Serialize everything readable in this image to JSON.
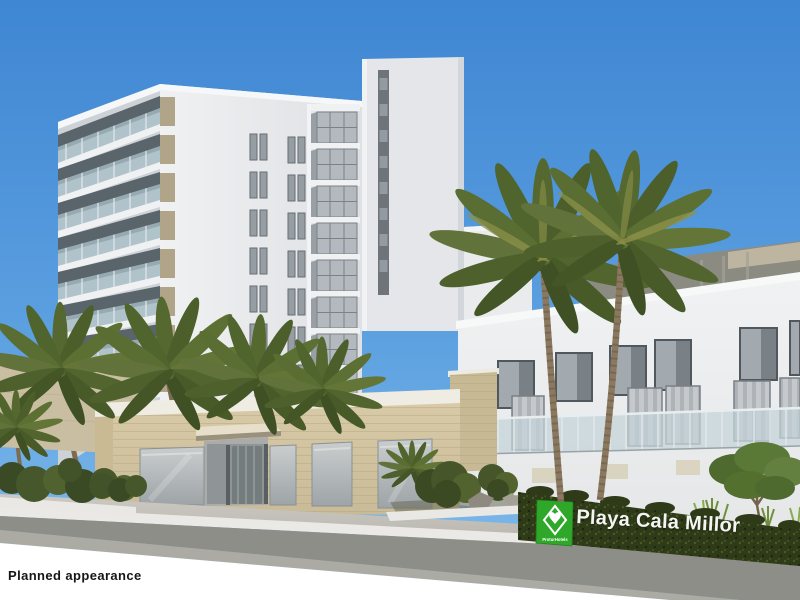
{
  "caption": {
    "text": "Planned appearance"
  },
  "hedge_sign": {
    "text": "Playa Cala Millor",
    "logo_text": "ProturHotels"
  },
  "colors": {
    "sky_top": "#3F86D3",
    "sky_horizon": "#7CB7EA",
    "building_white": "#EDEEF0",
    "podium_beige": "#CDBF9C",
    "hedge_green": "#2E3A18",
    "sign_green": "#2FA82A",
    "palm_green": "#55682F",
    "road_gray": "#8E8E88"
  }
}
